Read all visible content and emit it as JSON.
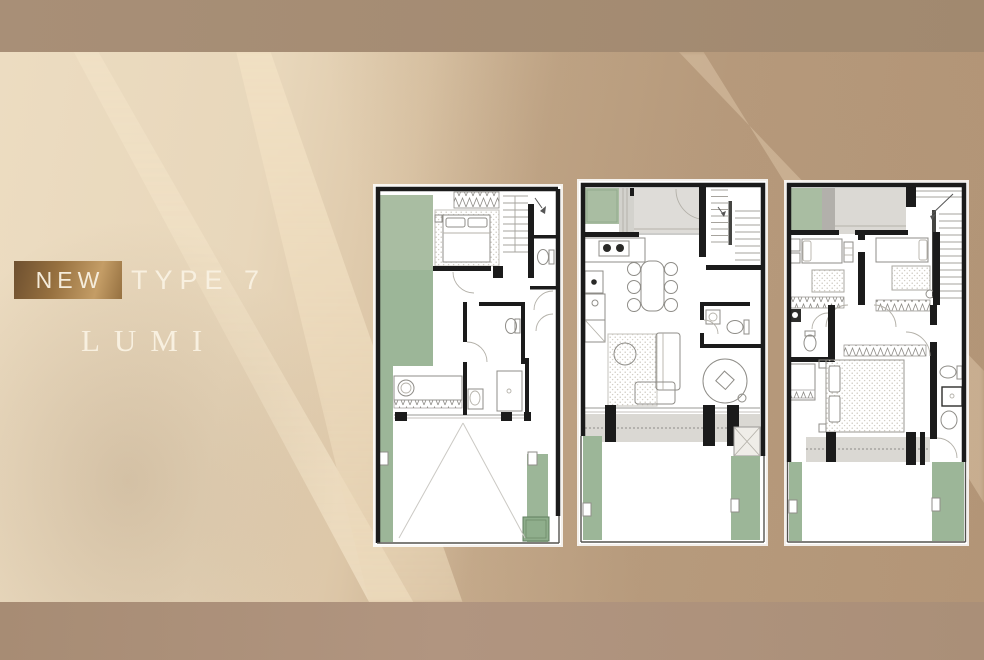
{
  "title": {
    "badge": "NEW",
    "type": "TYPE 7",
    "name": "LUMI"
  },
  "colors": {
    "background_cream": "#e8d7bb",
    "background_tan": "#ba9d7f",
    "band_top": "#a48b73",
    "band_bottom": "#ac9179",
    "badge_bronze_dark": "#6e5030",
    "badge_bronze_light": "#c49d66",
    "title_text": "#f8f0e0",
    "plan_wall": "#1b1b1b",
    "plan_green": "#9cb698",
    "plan_green_light": "#a9bda2",
    "plan_gray": "#dbd9d4"
  },
  "plans": [
    {
      "id": "floor-plan-left"
    },
    {
      "id": "floor-plan-middle"
    },
    {
      "id": "floor-plan-right"
    }
  ]
}
